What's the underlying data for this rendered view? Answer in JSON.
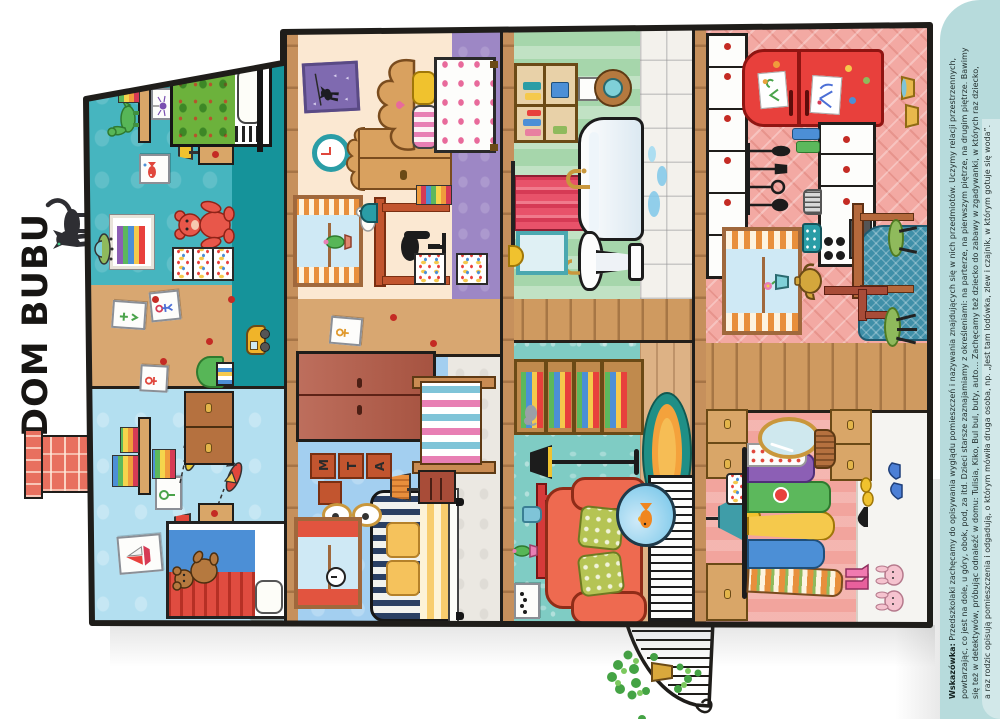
{
  "page": {
    "title": "DOM BUBU",
    "hint": {
      "label": "Wskazówka:",
      "lines": [
        "Przedszkolaki zachęcamy do opisywania wyglądu pomieszczeń i nazywania znajdujących się w nich przedmiotów. Uczymy relacji przestrzennych,",
        "powtarzając, co jest na dole, u góry, obok, pod, za itd. Dzieci starsze zaznajamiamy z określeniami: na parterze, na pierwszym piętrze, na drugim piętrze. Bawimy",
        "się też w detektywów, próbując odnaleźć w domu: Tulisia, Kiko, Bul bul, buty, auto… Zachęcamy też dziecko do zabawy w zgadywanki, w których raz dziecko,",
        "a raz rodzic opisują pomieszczenia i odgadują, o którym mówiła druga osoba, np. „Jest tam lodówka, zlew i czajnik, w którym gotuje się woda”."
      ]
    }
  },
  "palette": {
    "page_bg": "#ffffff",
    "outline": "#1f1d1a",
    "hint_strip_bg": "#b7dbdc",
    "chimney_brick": "#e8705f",
    "attic_left_wall": "#b3dff0",
    "attic_right_wall": "#46b5bf",
    "attic_floor": "#15939a",
    "bedroom_blue_wall": "#a3cff0",
    "bedroom_cream_wall": "#fbe8d2",
    "bedroom_purple_floor": "#9d87c5",
    "living_wall": "#7fccc4",
    "living_floor_wood": "#ddb285",
    "bath_wall": "#a6d6ab",
    "kitchen_wall": "#f3a9a3",
    "dressing_wall": "#f2a49d",
    "corridor_wood": "#d8a771",
    "fridge_red": "#e8403c",
    "armchair_orange": "#ee6a50",
    "rug_teal": "#3f8fa8"
  },
  "rooms": [
    {
      "name": "playroom-attic-left"
    },
    {
      "name": "kids-bedroom-attic-right"
    },
    {
      "name": "parents-bedroom-blue"
    },
    {
      "name": "bedroom-cream"
    },
    {
      "name": "living-room"
    },
    {
      "name": "bathroom"
    },
    {
      "name": "dressing-room"
    },
    {
      "name": "kitchen"
    }
  ]
}
